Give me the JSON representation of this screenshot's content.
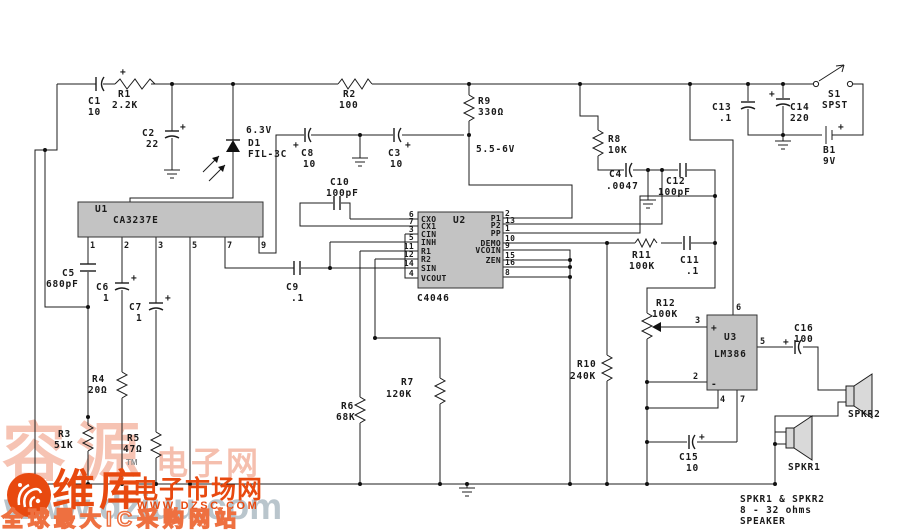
{
  "sym": {
    "plus": "+",
    "minus": "-"
  },
  "nets": {
    "v63": "6.3V",
    "v55": "5.5-6V"
  },
  "components": {
    "c1": {
      "ref": "C1",
      "val": "10"
    },
    "r1": {
      "ref": "R1",
      "val": "2.2K"
    },
    "r2": {
      "ref": "R2",
      "val": "100"
    },
    "c2": {
      "ref": "C2",
      "val": "22"
    },
    "d1": {
      "ref": "D1",
      "val": "FIL-3C"
    },
    "c8": {
      "ref": "C8",
      "val": "10"
    },
    "c3": {
      "ref": "C3",
      "val": "10"
    },
    "c10": {
      "ref": "C10",
      "val": "100pF"
    },
    "r9": {
      "ref": "R9",
      "val": "330Ω"
    },
    "r8": {
      "ref": "R8",
      "val": "10K"
    },
    "c4": {
      "ref": "C4",
      "val": ".0047"
    },
    "c12": {
      "ref": "C12",
      "val": "100pF"
    },
    "c13": {
      "ref": "C13",
      "val": ".1"
    },
    "c14": {
      "ref": "C14",
      "val": "220"
    },
    "s1": {
      "ref": "S1",
      "val": "SPST"
    },
    "b1": {
      "ref": "B1",
      "val": "9V"
    },
    "c5": {
      "ref": "C5",
      "val": "680pF"
    },
    "c6": {
      "ref": "C6",
      "val": "1"
    },
    "c7": {
      "ref": "C7",
      "val": "1"
    },
    "r3": {
      "ref": "R3",
      "val": "51K"
    },
    "r4": {
      "ref": "R4",
      "val": "20Ω"
    },
    "r5": {
      "ref": "R5",
      "val": "47Ω"
    },
    "r6": {
      "ref": "R6",
      "val": "68K"
    },
    "r7": {
      "ref": "R7",
      "val": "120K"
    },
    "c9": {
      "ref": "C9",
      "val": ".1"
    },
    "r10": {
      "ref": "R10",
      "val": "240K"
    },
    "r11": {
      "ref": "R11",
      "val": "100K"
    },
    "c11": {
      "ref": "C11",
      "val": ".1"
    },
    "r12": {
      "ref": "R12",
      "val": "100K"
    },
    "c15": {
      "ref": "C15",
      "val": "10"
    },
    "c16": {
      "ref": "C16",
      "val": "100"
    }
  },
  "ics": {
    "u1": {
      "ref": "U1",
      "part": "CA3237E",
      "pins": [
        "1",
        "2",
        "3",
        "5",
        "7",
        "9"
      ]
    },
    "u2": {
      "ref": "U2",
      "part": "C4046",
      "left": [
        {
          "n": "6",
          "l": "CXO"
        },
        {
          "n": "7",
          "l": "CX1"
        },
        {
          "n": "3",
          "l": "CIN"
        },
        {
          "n": "5",
          "l": "INH"
        },
        {
          "n": "11",
          "l": "R1"
        },
        {
          "n": "12",
          "l": "R2"
        },
        {
          "n": "14",
          "l": "SIN"
        },
        {
          "n": "4",
          "l": "VCOUT"
        }
      ],
      "right": [
        {
          "n": "2",
          "l": "P1"
        },
        {
          "n": "13",
          "l": "P2"
        },
        {
          "n": "1",
          "l": "PP"
        },
        {
          "n": "10",
          "l": "DEMO"
        },
        {
          "n": "9",
          "l": "VCOIN"
        },
        {
          "n": "15",
          "l": "ZEN"
        },
        {
          "n": "16",
          "l": ""
        },
        {
          "n": "8",
          "l": ""
        }
      ]
    },
    "u3": {
      "ref": "U3",
      "part": "LM386",
      "pins": {
        "p2": "2",
        "p3": "3",
        "p4": "4",
        "p5": "5",
        "p6": "6",
        "p7": "7"
      }
    }
  },
  "speakers": {
    "spkr1": "SPKR1",
    "spkr2": "SPKR2"
  },
  "note": {
    "l1": "SPKR1 & SPKR2",
    "l2": "8 - 32 ohms",
    "l3": "SPEAKER"
  },
  "watermark": {
    "big_pink_1": "容源",
    "big_pink_2": "电子网",
    "tm": "TM",
    "orange_main": "维库",
    "orange_sub": "电子市场网",
    "orange_url": "WWW.DZSC.COM",
    "gray_url": "www.dziuu.com",
    "bottom_line": "全球最大IC采购网站",
    "colors": {
      "pink": "#f5b9a6",
      "orange": "#e8490f",
      "gray": "#b6c2ca"
    }
  }
}
